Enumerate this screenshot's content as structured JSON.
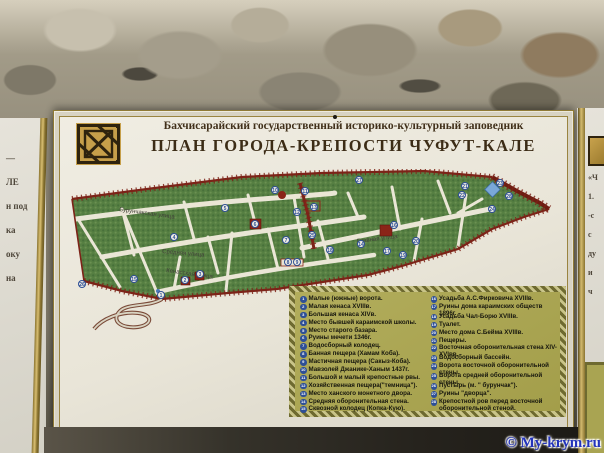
{
  "colors": {
    "sign_bg": "#ece8db",
    "legend_bg": "#a9a452",
    "legend_border": "#6e6a30",
    "marker_blue": "#2e4f96",
    "wall_red": "#7c2318",
    "map_green": "#567f42",
    "gold": "#b8973f",
    "title_brown": "#3c2c16",
    "watermark_blue": "#2233bb"
  },
  "sign": {
    "supertitle": "Бахчисарайский государственный историко-культурный заповедник",
    "title": "ПЛАН ГОРОДА-КРЕПОСТИ ЧУФУТ-КАЛЕ",
    "emblem_icon": "karaite-knot-emblem"
  },
  "map": {
    "street_labels": [
      "Бурунчакская улица",
      "Средняя улица",
      "Кенасская улица",
      "Главная улица"
    ],
    "markers": [
      {
        "n": "1",
        "x": 99,
        "y": 126
      },
      {
        "n": "2",
        "x": 123,
        "y": 111
      },
      {
        "n": "3",
        "x": 138,
        "y": 105
      },
      {
        "n": "4",
        "x": 112,
        "y": 68
      },
      {
        "n": "5",
        "x": 163,
        "y": 39
      },
      {
        "n": "6",
        "x": 193,
        "y": 55
      },
      {
        "n": "7",
        "x": 224,
        "y": 71
      },
      {
        "n": "8",
        "x": 226,
        "y": 93
      },
      {
        "n": "9",
        "x": 235,
        "y": 93
      },
      {
        "n": "10",
        "x": 213,
        "y": 21
      },
      {
        "n": "11",
        "x": 243,
        "y": 22
      },
      {
        "n": "12",
        "x": 235,
        "y": 43
      },
      {
        "n": "13",
        "x": 252,
        "y": 38
      },
      {
        "n": "14",
        "x": 299,
        "y": 75
      },
      {
        "n": "15",
        "x": 72,
        "y": 110
      },
      {
        "n": "16",
        "x": 332,
        "y": 56
      },
      {
        "n": "17",
        "x": 325,
        "y": 82
      },
      {
        "n": "18",
        "x": 268,
        "y": 81
      },
      {
        "n": "19",
        "x": 341,
        "y": 86
      },
      {
        "n": "20",
        "x": 354,
        "y": 72
      },
      {
        "n": "21",
        "x": 403,
        "y": 17
      },
      {
        "n": "22",
        "x": 400,
        "y": 26
      },
      {
        "n": "23",
        "x": 438,
        "y": 14
      },
      {
        "n": "24",
        "x": 430,
        "y": 40
      },
      {
        "n": "25",
        "x": 250,
        "y": 66
      },
      {
        "n": "26",
        "x": 20,
        "y": 115
      },
      {
        "n": "27",
        "x": 297,
        "y": 11
      },
      {
        "n": "28",
        "x": 447,
        "y": 27
      }
    ]
  },
  "legend": {
    "columns": [
      {
        "items": [
          {
            "num": "1",
            "text": "Малые (южные) ворота."
          },
          {
            "num": "2",
            "text": "Малая кенаса XVIIIв."
          },
          {
            "num": "3",
            "text": "Большая кенаса XIVв."
          },
          {
            "num": "4",
            "text": "Место бывшей караимской школы."
          },
          {
            "num": "5",
            "text": "Место старого базара."
          },
          {
            "num": "6",
            "text": "Руины мечети 1346г."
          },
          {
            "num": "7",
            "text": "Водосборный колодец."
          },
          {
            "num": "8",
            "text": "Банная пещера (Хамам Коба)."
          },
          {
            "num": "9",
            "text": "Мастичная пещера (Сакыз-Коба)."
          },
          {
            "num": "10",
            "text": "Мавзолей Джанике-Ханым 1437г."
          },
          {
            "num": "11",
            "text": "Большой и малый крепостные рвы."
          },
          {
            "num": "12",
            "text": "Хозяйственная пещера(\"темница\")."
          },
          {
            "num": "13",
            "text": "Место ханского монетного двора."
          },
          {
            "num": "14",
            "text": "Средняя оборонительная стена."
          },
          {
            "num": "15",
            "text": "Сквозной колодец (Копка-Кую)."
          }
        ]
      },
      {
        "items": [
          {
            "num": "16",
            "text": "Усадьба А.С.Фирковича XVIIIв."
          },
          {
            "num": "17",
            "text": "Руины дома караимских обществ 1896г."
          },
          {
            "num": "18",
            "text": "Усадьба Чал-Борю XVIIIв."
          },
          {
            "num": "19",
            "text": "Туалет."
          },
          {
            "num": "20",
            "text": "Место дома С.Бейма XVIIIв."
          },
          {
            "num": "21",
            "text": "Пещеры."
          },
          {
            "num": "22",
            "text": "Восточная оборонительная стена XIV-XVIвв."
          },
          {
            "num": "23",
            "text": "Водосборный бассейн."
          },
          {
            "num": "24",
            "text": "Ворота восточной оборонительной стены."
          },
          {
            "num": "25",
            "text": "Ворота средней оборонительной стены."
          },
          {
            "num": "26",
            "text": "Пустырь (м. \" бурунчак\")."
          },
          {
            "num": "27",
            "text": "Руины \"дворца\"."
          },
          {
            "num": "28",
            "text": "Крепостной ров перед восточной оборонительной стеной."
          }
        ]
      }
    ]
  },
  "neighbors": {
    "left_fragments": [
      "—",
      "ЛЕ",
      "н под",
      "ка",
      "оку",
      "на"
    ],
    "right_fragments": [
      "«Ч",
      "1.",
      "-с",
      "с",
      "ду",
      "и",
      "ч"
    ]
  },
  "watermark": "© My-krym.ru"
}
